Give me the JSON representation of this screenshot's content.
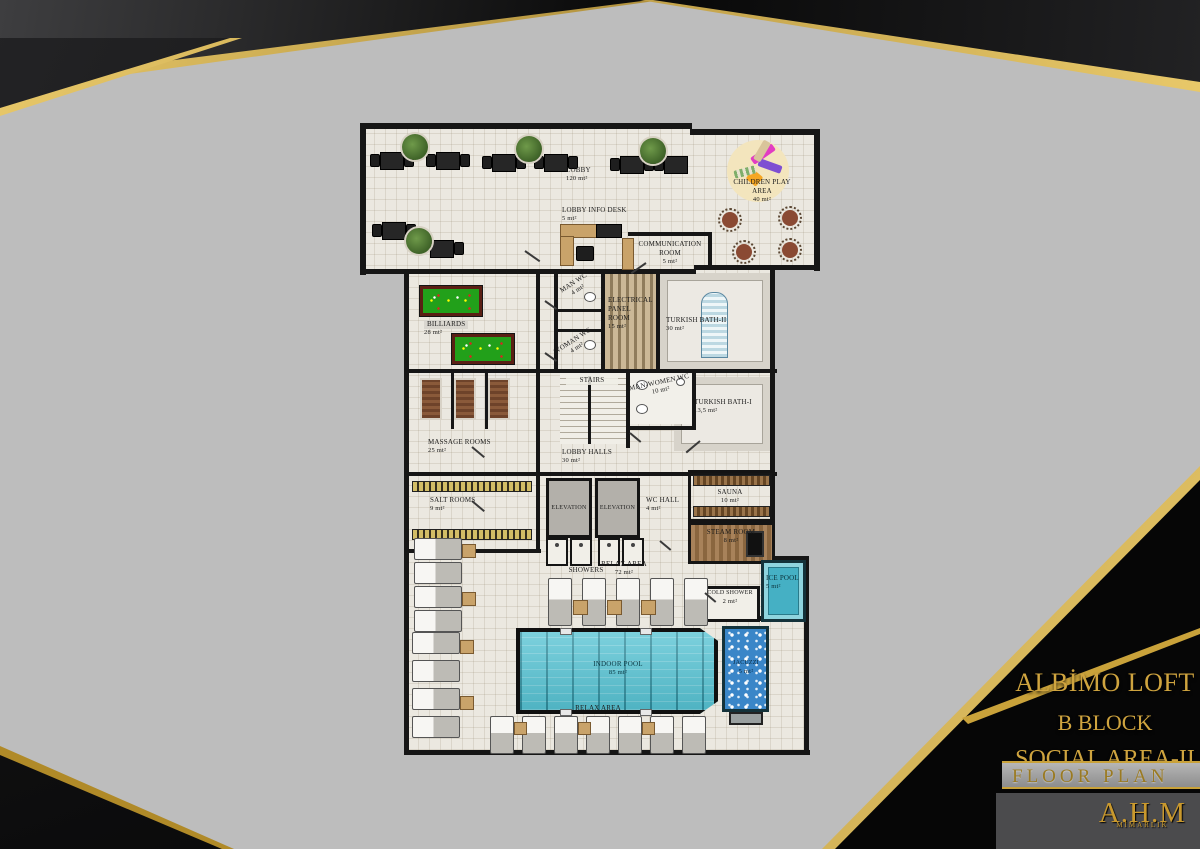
{
  "title_block": {
    "project": "ALBİMO LOFT",
    "block": "B BLOCK",
    "area_name": "SOCIAL AREA-II",
    "drawing_type": "FLOOR PLAN"
  },
  "logo": {
    "line1": "A.H.M",
    "line2": "MİMARLIK"
  },
  "colors": {
    "accent_gold": "#c9a23a",
    "background_gray": "#bdbdbd",
    "panel_black": "#0b0b0b",
    "floor": "#ebe8e0",
    "wall": "#161616",
    "pool_teal": "#58c4d4",
    "jacuzzi_blue": "#3a86c8",
    "billiard_green": "#22a01a"
  },
  "rooms": {
    "lobby": {
      "name": "LOBBY",
      "area": "120 mt²"
    },
    "info_desk": {
      "name": "LOBBY INFO DESK",
      "area": "5 mt²"
    },
    "comm_room": {
      "name": "COMMUNICATION ROOM",
      "area": "5 mt²"
    },
    "children": {
      "name": "CHILDREN PLAY AREA",
      "area": "40 mt²"
    },
    "billiards": {
      "name": "BILLIARDS",
      "area": "28 mt²"
    },
    "man_wc": {
      "name": "MAN WC",
      "area": "4 mt²"
    },
    "electrical": {
      "name": "ELECTRICAL PANEL ROOM",
      "area": "15 mt²"
    },
    "turkish2": {
      "name": "TURKISH BATH-II",
      "area": "30 mt²"
    },
    "woman_wc": {
      "name": "WOMAN WC",
      "area": "4 mt²"
    },
    "stairs": {
      "name": "STAIRS",
      "area": ""
    },
    "mw_wc": {
      "name": "MAN-WOMEN WC",
      "area": "10 mt²"
    },
    "turkish1": {
      "name": "TURKISH BATH-I",
      "area": "13,5 mt²"
    },
    "massage": {
      "name": "MASSAGE ROOMS",
      "area": "25 mt²"
    },
    "lobby_halls": {
      "name": "LOBBY HALLS",
      "area": "30 mt²"
    },
    "salt": {
      "name": "SALT ROOMS",
      "area": "9 mt²"
    },
    "elevator1": {
      "name": "ELEVATION",
      "area": ""
    },
    "elevator2": {
      "name": "ELEVATION",
      "area": ""
    },
    "wc_hall": {
      "name": "WC HALL",
      "area": "4 mt²"
    },
    "sauna": {
      "name": "SAUNA",
      "area": "10 mt²"
    },
    "steam": {
      "name": "STEAM ROOM",
      "area": "8 mt²"
    },
    "showers": {
      "name": "SHOWERS",
      "area": ""
    },
    "relax1": {
      "name": "RELAX AREA",
      "area": "72 mt²"
    },
    "ice_pool": {
      "name": "ICE POOL",
      "area": "5 mt²"
    },
    "cold_shower": {
      "name": "COLD SHOWER",
      "area": "2 mt²"
    },
    "pool": {
      "name": "INDOOR POOL",
      "area": "85 mt²"
    },
    "jacuzzi": {
      "name": "JACUZZI",
      "area": "5 mt²"
    },
    "relax2": {
      "name": "RELAX AREA",
      "area": ""
    }
  }
}
